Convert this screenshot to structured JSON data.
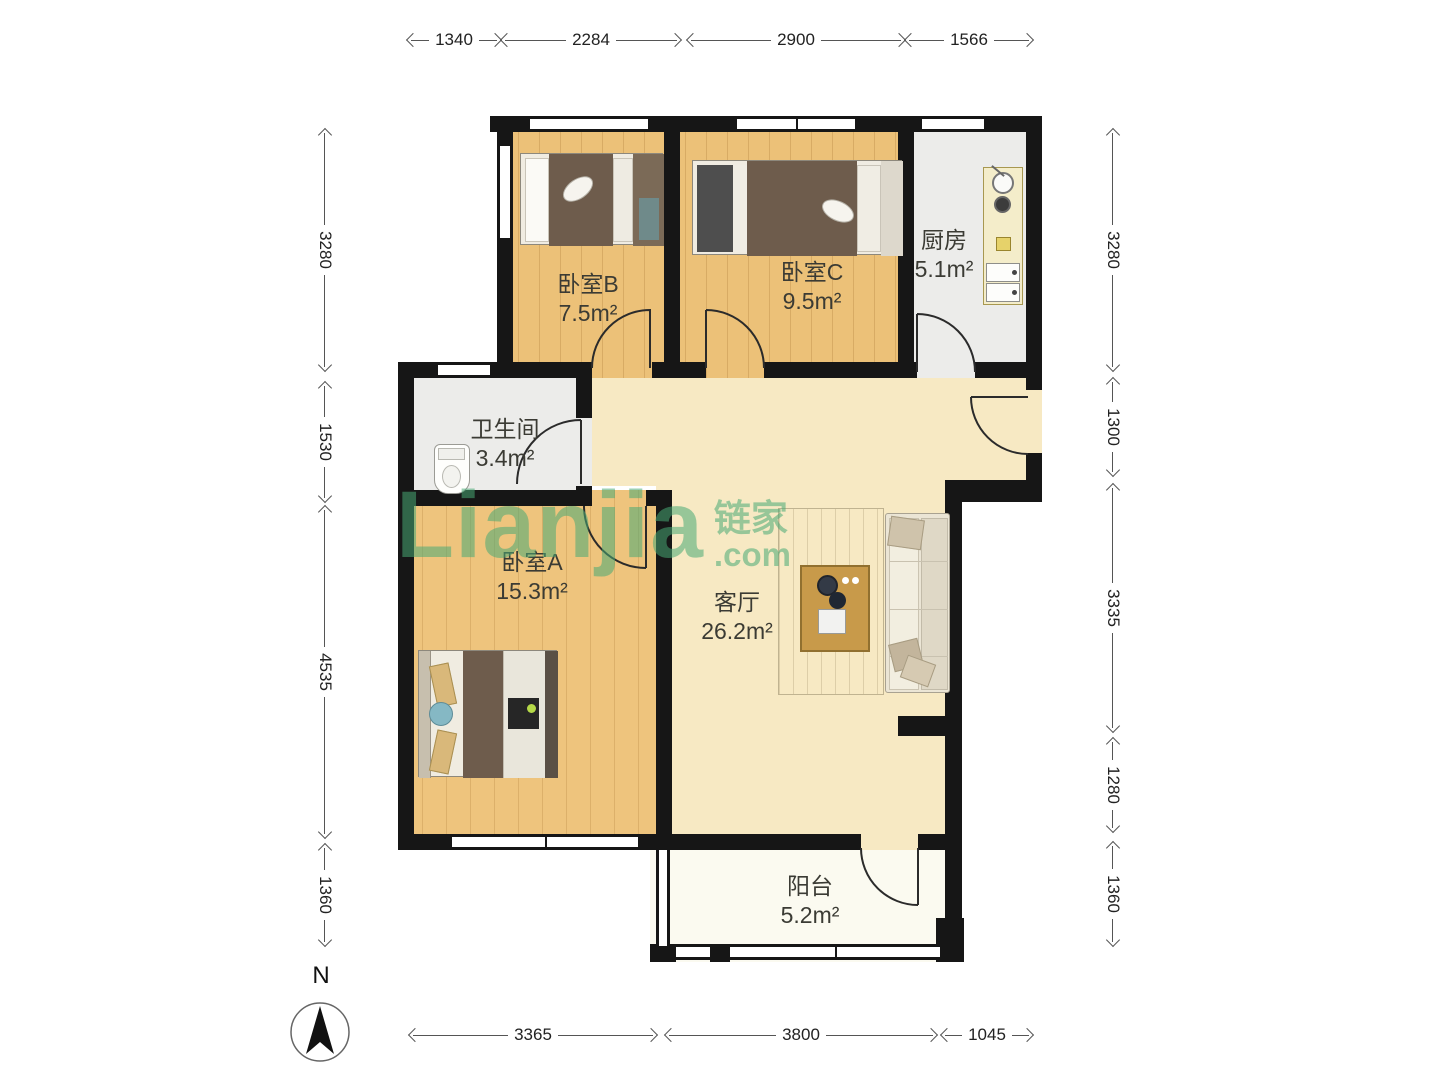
{
  "floorplan": {
    "rooms": [
      {
        "id": "bedroom-b",
        "name": "卧室B",
        "area": "7.5m²"
      },
      {
        "id": "bedroom-c",
        "name": "卧室C",
        "area": "9.5m²"
      },
      {
        "id": "kitchen",
        "name": "厨房",
        "area": "5.1m²"
      },
      {
        "id": "bathroom",
        "name": "卫生间",
        "area": "3.4m²"
      },
      {
        "id": "bedroom-a",
        "name": "卧室A",
        "area": "15.3m²"
      },
      {
        "id": "living",
        "name": "客厅",
        "area": "26.2m²"
      },
      {
        "id": "balcony",
        "name": "阳台",
        "area": "5.2m²"
      }
    ],
    "dimensions_mm": {
      "top": [
        "1340",
        "2284",
        "2900",
        "1566"
      ],
      "left": [
        "3280",
        "1530",
        "4535",
        "1360"
      ],
      "right": [
        "3280",
        "1300",
        "3335",
        "1280",
        "1360"
      ],
      "bottom": [
        "3365",
        "3800",
        "1045"
      ]
    },
    "compass": {
      "label": "N"
    },
    "watermark": {
      "brand": "Lianjia",
      "brand_cn": "链家",
      "suffix": ".com",
      "color": "#48aa74"
    },
    "colors": {
      "wall": "#161616",
      "wood_floor": "#ecc178",
      "living_floor": "#f7e9c3",
      "tile_floor": "#ececea",
      "balcony_floor": "#fbfaf0"
    }
  }
}
